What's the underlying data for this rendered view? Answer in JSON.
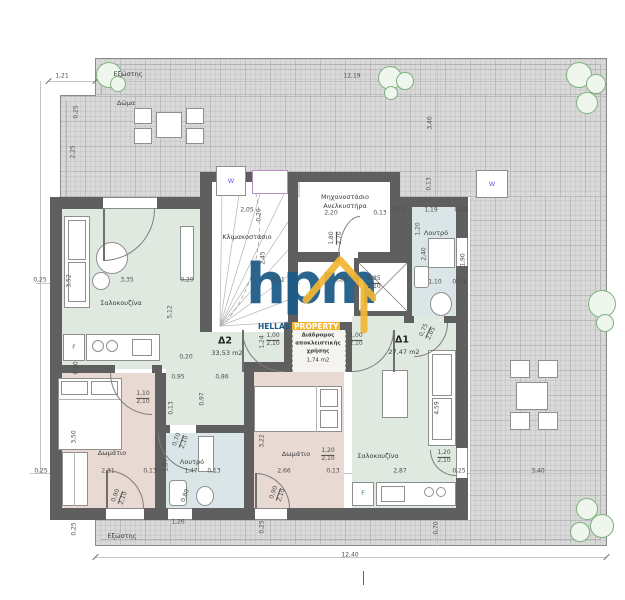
{
  "watermark": {
    "word": "hpm",
    "brand_top": "HELLAS",
    "brand_bottom": "PROPERTY",
    "blue": "#1a5a87",
    "yellow": "#f2b633"
  },
  "rooms": {
    "terrace": "Δώμα",
    "balcony_top": "Εξώστης",
    "balcony_bottom": "Εξώστης",
    "stairwell": "Κλιμακοστάσιο",
    "machine_room": [
      "Μηχανοστάσιο",
      "Ανελκυστήρα"
    ],
    "bath": "Λουτρό",
    "living": "Σαλοκουζίνα",
    "bedroom": "Δωμάτιο",
    "apt_d2": {
      "name": "Δ2",
      "area": "33,53 m2"
    },
    "apt_d1": {
      "name": "Δ1",
      "area": "27,47 m2"
    },
    "corridor": [
      "Διάδρομος",
      "αποκλειστικής",
      "χρήσης",
      "1,74 m2"
    ],
    "skylight": "W",
    "fridge": "F"
  },
  "colors": {
    "wall": "#5f5f5f",
    "living": "#dfe9df",
    "bedroom": "#e8d9d2",
    "bath": "#d9e5e7",
    "terrace": "#d9d9d9"
  },
  "dims": [
    {
      "t": "1,21",
      "x": 62,
      "y": 77
    },
    {
      "t": "0,25",
      "x": 77,
      "y": 112,
      "r": -90
    },
    {
      "t": "2,25",
      "x": 74,
      "y": 152,
      "r": -90
    },
    {
      "t": "12,19",
      "x": 352,
      "y": 77
    },
    {
      "t": "3,40",
      "x": 431,
      "y": 123,
      "r": -90
    },
    {
      "t": "0,25",
      "x": 40,
      "y": 281
    },
    {
      "t": "3,52",
      "x": 70,
      "y": 281,
      "r": -90
    },
    {
      "t": "3,35",
      "x": 127,
      "y": 281
    },
    {
      "t": "0,20",
      "x": 187,
      "y": 281
    },
    {
      "t": "3,61",
      "x": 278,
      "y": 281
    },
    {
      "t": "0,85",
      "x": 341,
      "y": 281
    },
    {
      "t": "0,85",
      "b": "2,10",
      "x": 374,
      "y": 283
    },
    {
      "t": "2,05",
      "x": 247,
      "y": 211
    },
    {
      "t": "0,20",
      "x": 260,
      "y": 215,
      "r": -90
    },
    {
      "t": "2,45",
      "x": 264,
      "y": 258,
      "r": -90
    },
    {
      "t": "2,20",
      "x": 331,
      "y": 214
    },
    {
      "t": "0,13",
      "x": 380,
      "y": 214
    },
    {
      "t": "1,80",
      "b": "2,70",
      "x": 336,
      "y": 238,
      "r": -90
    },
    {
      "t": "0,13",
      "x": 399,
      "y": 211
    },
    {
      "t": "1,19",
      "x": 431,
      "y": 211
    },
    {
      "t": "0,13",
      "x": 461,
      "y": 211
    },
    {
      "t": "0,13",
      "x": 430,
      "y": 184,
      "r": -90
    },
    {
      "t": "1,20",
      "x": 419,
      "y": 229,
      "r": -90
    },
    {
      "t": "2,40",
      "x": 425,
      "y": 254,
      "r": -90
    },
    {
      "t": "1,10",
      "x": 435,
      "y": 283
    },
    {
      "t": "0,13",
      "x": 459,
      "y": 283
    },
    {
      "t": "1,90",
      "x": 464,
      "y": 260,
      "r": -90
    },
    {
      "t": "0,75",
      "b": "2,05",
      "x": 428,
      "y": 332,
      "r": -65
    },
    {
      "t": "1,24",
      "x": 263,
      "y": 342,
      "r": -90
    },
    {
      "t": "1,00",
      "b": "2,10",
      "x": 273,
      "y": 340
    },
    {
      "t": "1,00",
      "b": "2,10",
      "x": 356,
      "y": 340
    },
    {
      "t": "5,12",
      "x": 171,
      "y": 312,
      "r": -90
    },
    {
      "t": "0,20",
      "x": 186,
      "y": 358
    },
    {
      "t": "0,95",
      "x": 178,
      "y": 378
    },
    {
      "t": "0,86",
      "x": 222,
      "y": 378
    },
    {
      "t": "0,97",
      "x": 203,
      "y": 399,
      "r": -90
    },
    {
      "t": "0,13",
      "x": 172,
      "y": 408,
      "r": -90
    },
    {
      "t": "0,10",
      "x": 77,
      "y": 368,
      "r": -90
    },
    {
      "t": "1,10",
      "b": "2,10",
      "x": 143,
      "y": 398
    },
    {
      "t": "3,50",
      "x": 75,
      "y": 437,
      "r": -90
    },
    {
      "t": "0,25",
      "x": 41,
      "y": 472
    },
    {
      "t": "2,31",
      "x": 108,
      "y": 472
    },
    {
      "t": "0,13",
      "x": 150,
      "y": 472
    },
    {
      "t": "1,87",
      "x": 167,
      "y": 465,
      "r": -90
    },
    {
      "t": "1,47",
      "x": 191,
      "y": 472
    },
    {
      "t": "0,13",
      "x": 214,
      "y": 472
    },
    {
      "t": "0,70",
      "b": "2,10",
      "x": 181,
      "y": 441,
      "r": -70
    },
    {
      "t": "3,22",
      "x": 263,
      "y": 441,
      "r": -90
    },
    {
      "t": "2,66",
      "x": 284,
      "y": 472
    },
    {
      "t": "1,20",
      "b": "2,10",
      "x": 328,
      "y": 455
    },
    {
      "t": "0,13",
      "x": 333,
      "y": 472
    },
    {
      "t": "4,59",
      "x": 438,
      "y": 408,
      "r": -90
    },
    {
      "t": "1,20",
      "b": "2,10",
      "x": 444,
      "y": 457
    },
    {
      "t": "2,87",
      "x": 400,
      "y": 472
    },
    {
      "t": "0,25",
      "x": 459,
      "y": 472
    },
    {
      "t": "3,40",
      "x": 538,
      "y": 472
    },
    {
      "t": "0,90",
      "b": "2,10",
      "x": 120,
      "y": 497,
      "r": -70
    },
    {
      "t": "0,80",
      "x": 186,
      "y": 496,
      "r": -70
    },
    {
      "t": "0,90",
      "b": "2,10",
      "x": 278,
      "y": 494,
      "r": -70
    },
    {
      "t": "1,26",
      "x": 178,
      "y": 523
    },
    {
      "t": "0,25",
      "x": 75,
      "y": 529,
      "r": -90
    },
    {
      "t": "0,25",
      "x": 263,
      "y": 527,
      "r": -90
    },
    {
      "t": "0,70",
      "x": 437,
      "y": 528,
      "r": -90
    },
    {
      "t": "12,40",
      "x": 350,
      "y": 556
    }
  ]
}
